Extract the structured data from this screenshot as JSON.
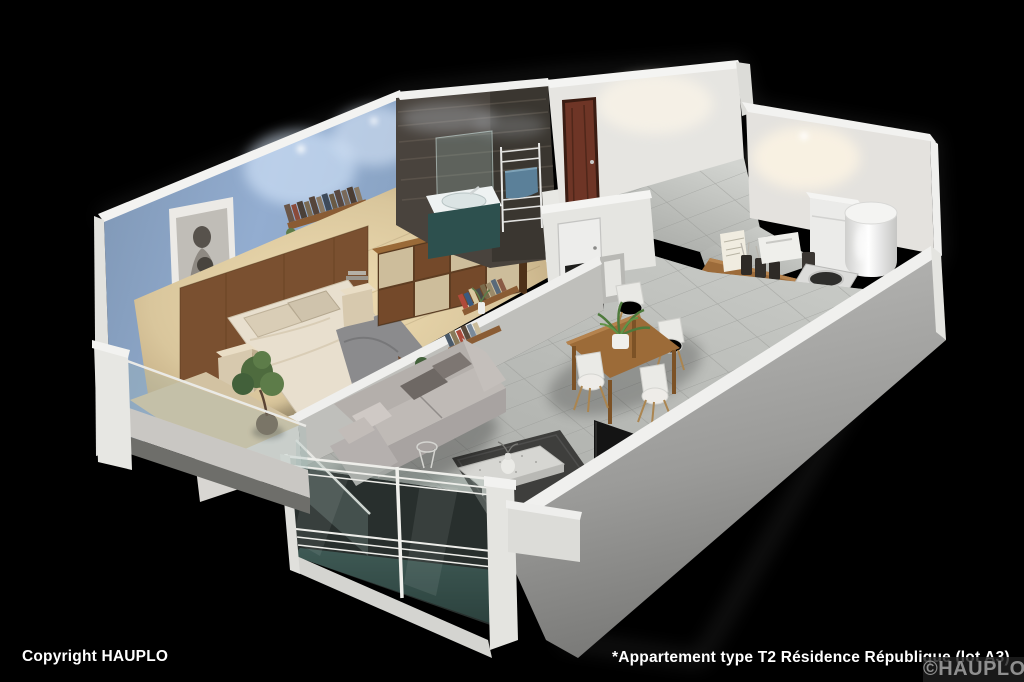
{
  "footer": {
    "copyright": "Copyright HAUPLO",
    "caption": "*Appartement type T2 Résidence République (lot A3)",
    "watermark": "©HAUPLO"
  },
  "colors": {
    "background": "#000000",
    "bedroom_wall": "#8da8c6",
    "white_wall": "#e6e5e1",
    "bathroom_tile": "#49433d",
    "wood_floor": "#d9c69c",
    "tile_floor": "#b7b9b5",
    "balcony_glass_dark": "#35504b",
    "entry_door": "#6e3526",
    "sofa": "#b4afab",
    "rug": "#3e3e3c",
    "dining_table": "#9c6b38",
    "vanity_teal": "#3d6b68",
    "towel_blue": "#5b8099",
    "wardrobe_walnut": "#74492a",
    "wardrobe_champagne": "#cdbd9b",
    "headboard_wood": "#7a5030",
    "front_wall_gray": "#9b9b99"
  }
}
